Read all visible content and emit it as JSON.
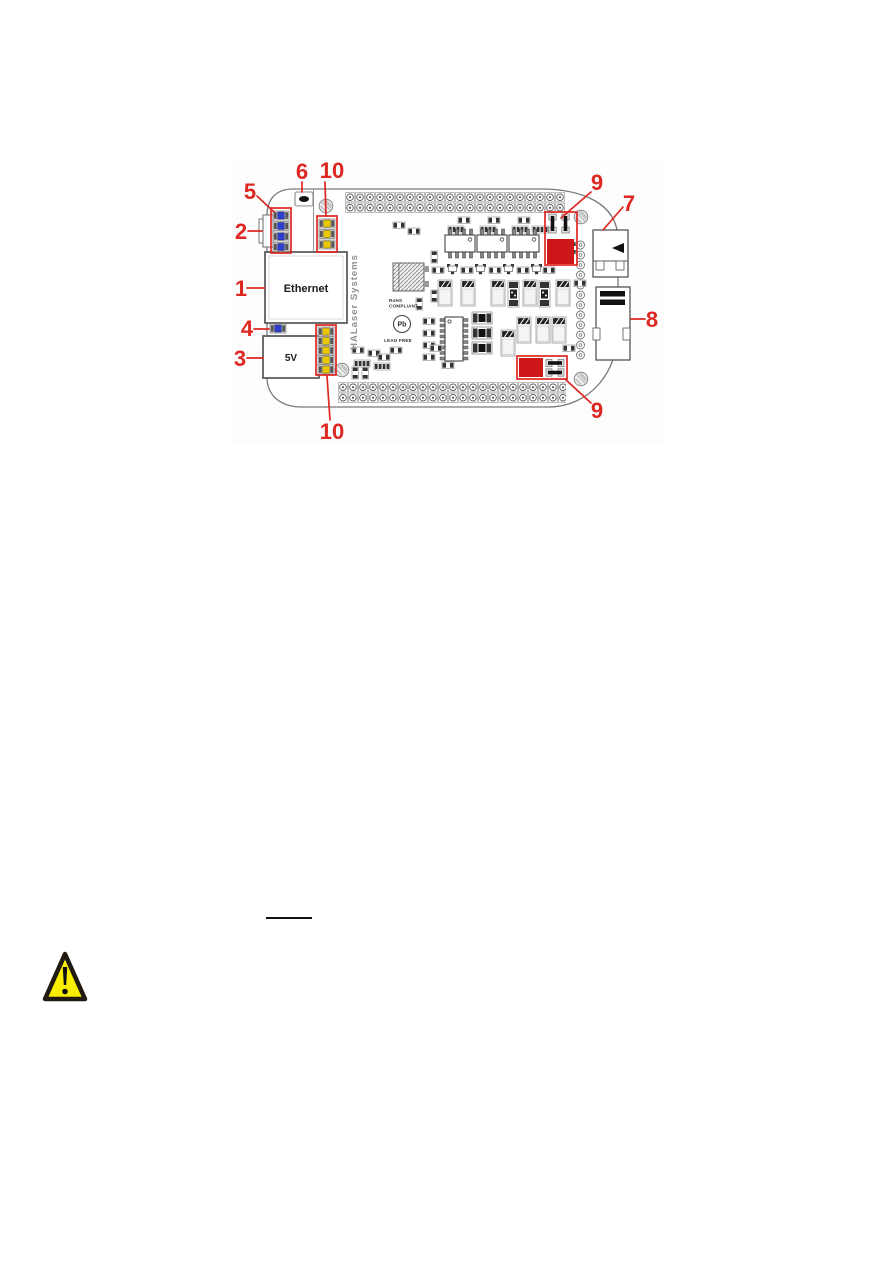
{
  "document": {
    "figure": {
      "callouts": {
        "n1": "1",
        "n2": "2",
        "n3": "3",
        "n4": "4",
        "n5": "5",
        "n6": "6",
        "n7": "7",
        "n8": "8",
        "n9": "9",
        "n10": "10"
      },
      "board": {
        "ethernet_label": "Ethernet",
        "power_label": "5V",
        "brand": "HALaser Systems",
        "rohs_line1": "RoHS",
        "rohs_line2": "COMPLIANT",
        "pb_symbol": "Pb",
        "lead_free": "LEAD FREE"
      },
      "colors": {
        "callout-red": "#de2721",
        "highlight-red": "#cd1719",
        "led-blue": "#2e3ecf",
        "led-yellow": "#eac800",
        "warning-yellow": "#f8ee00"
      }
    }
  }
}
